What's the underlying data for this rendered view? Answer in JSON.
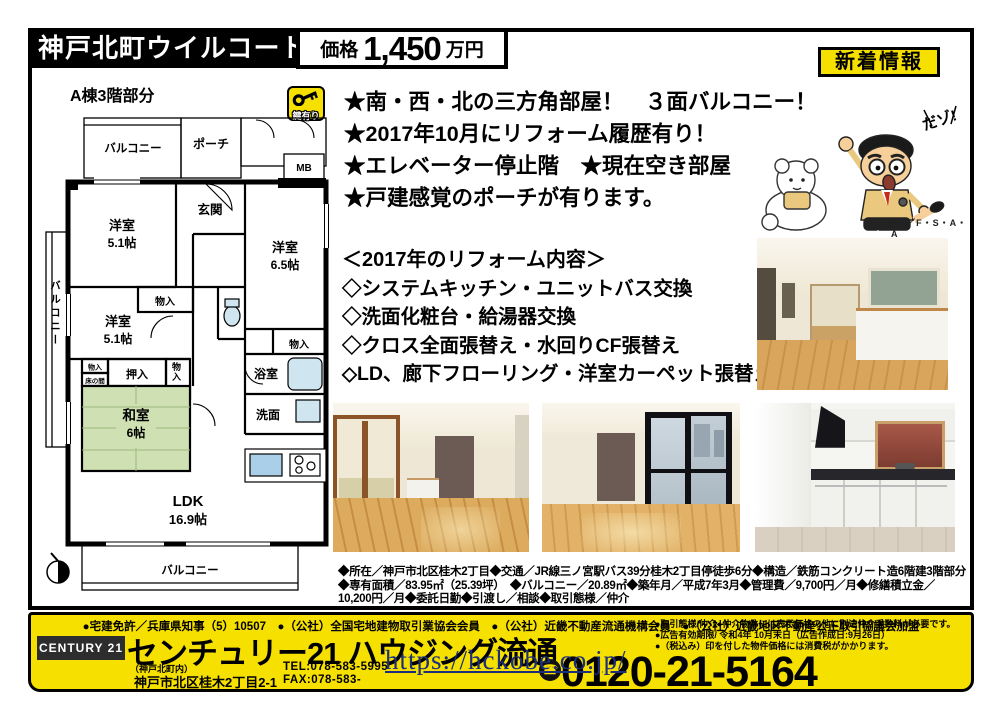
{
  "header": {
    "title": "神戸北町ウイルコート",
    "price_label": "価格",
    "price_value": "1,450",
    "price_unit": "万円",
    "new_badge": "新着情報"
  },
  "floorplan": {
    "building": "A棟3階部分",
    "key_badge": "鍵有り",
    "labels": {
      "balcony": "バルコニー",
      "porch": "ポーチ",
      "mb": "MB",
      "genkan": "玄関",
      "western": "洋室",
      "western1_size": "5.1帖",
      "western2_size": "6.5帖",
      "western3_size": "5.1帖",
      "closet": "物入",
      "oshiire": "押入",
      "tokonoma": "床の間",
      "washitsu": "和室",
      "washitsu_size": "6帖",
      "bath": "浴室",
      "wash": "洗面",
      "ldk": "LDK",
      "ldk_size": "16.9帖"
    }
  },
  "highlights": [
    "★南・西・北の三方角部屋！　３面バルコニー！",
    "★2017年10月にリフォーム履歴有り！",
    "★エレベーター停止階　★現在空き部屋",
    "★戸建感覚のポーチが有ります。"
  ],
  "reform": {
    "title": "＜2017年のリフォーム内容＞",
    "items": [
      "◇システムキッチン・ユニットバス交換",
      "◇洗面化粧台・給湯器交換",
      "◇クロス全面張替え・水回りCF張替え",
      "◇LD、廊下フローリング・洋室カーペット張替え"
    ]
  },
  "character": {
    "speech": "だゾ!",
    "copyright": "©U／F・S・A・A"
  },
  "details": "◆所在／神戸市北区桂木2丁目◆交通／JR線三ノ宮駅バス39分桂木2丁目停徒歩6分◆構造／鉄筋コンクリート造6階建3階部分◆専有面積／83.95㎡（25.39坪）　◆バルコニー／20.89㎡◆築年月／平成7年3月◆管理費／9,700円／月◆修繕積立金／10,200円／月◆委託日勤◆引渡し／相談◆取引態様／仲介",
  "footer": {
    "license_line": "●宅建免許／兵庫県知事（5）10507　●（公社）全国宅地建物取引業協会会員　●（公社）近畿不動産流通機構会員　●（公社）近畿地区不動産公正取引協議会加盟",
    "logo": "CENTURY 21",
    "company": "センチュリー21 ハウジング流通",
    "branch": "（神戸北町内）",
    "address": "神戸市北区桂木2丁目2-1",
    "tel": "TEL:078-583-5995",
    "fax": "FAX:078-583-",
    "notes": [
      "●取引態様/仲介●仲介物件には表示価格の他に別途仲介手数料が必要です。",
      "●広告有効期限/ 令和4年 10月末日（広告作成日:9月26日）",
      "●（税込み）印を付した物件価格には消費税がかかります。"
    ],
    "phone": "0120-21-5164"
  },
  "watermark": "https://hckobe.co.jp/",
  "colors": {
    "accent_yellow": "#f6e000",
    "tatami_green": "#cfe0b2",
    "watermark_blue": "#1c2f7c"
  }
}
